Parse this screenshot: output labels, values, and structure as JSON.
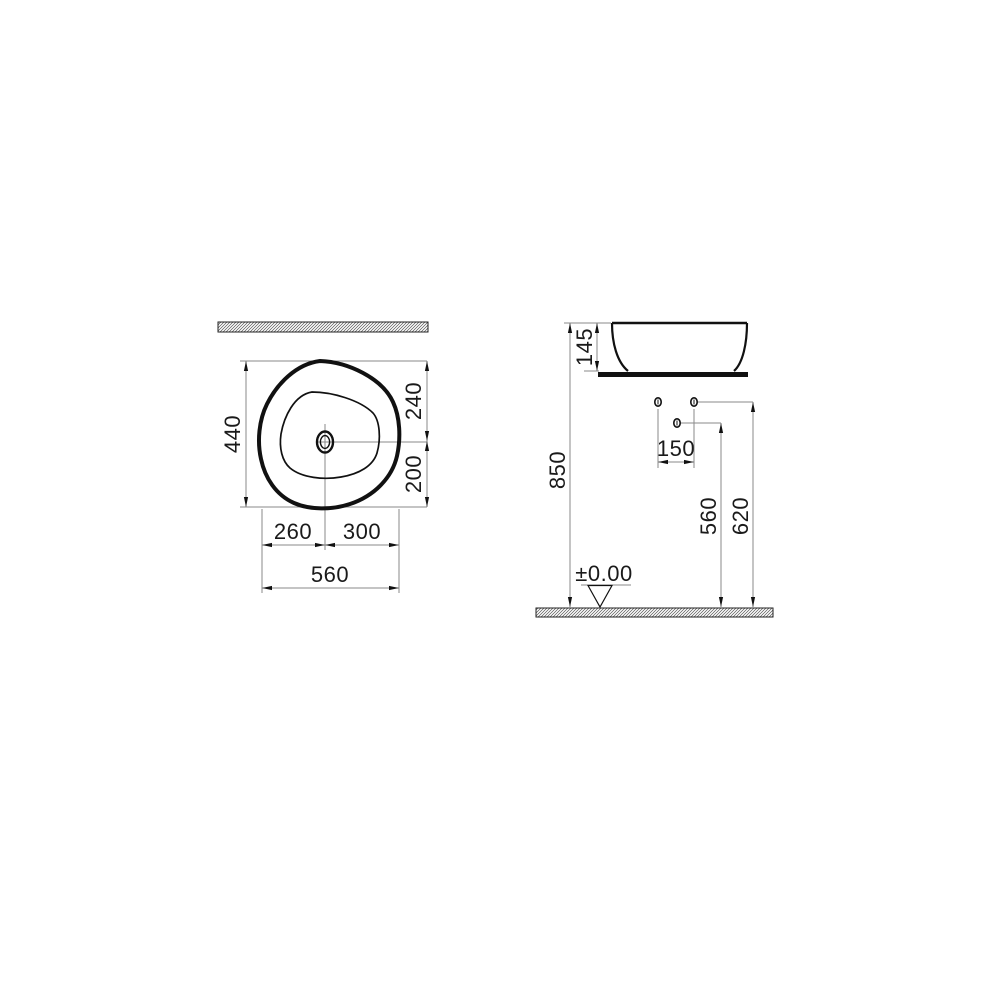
{
  "page": {
    "background": "#ffffff"
  },
  "drawing": {
    "type": "technical-dimension-drawing",
    "subject": "countertop washbasin, plan view and side elevation",
    "views": {
      "plan": {
        "name": "plan-view",
        "dimensions": {
          "overall_depth": "440",
          "edge_to_drain": "240",
          "drain_to_edge": "200",
          "left_of_drain": "260",
          "right_of_drain": "300",
          "overall_width": "560"
        }
      },
      "side": {
        "name": "side-elevation",
        "dimensions": {
          "basin_height": "145",
          "rim_height_from_floor": "850",
          "tap_hole_spacing": "150",
          "mixer_hole_height": "560",
          "supply_hole_height": "620",
          "floor_datum": "±0.00"
        }
      }
    },
    "colors": {
      "object_line": "#111111",
      "dimension_line": "#8a8a8a",
      "text": "#1a1a1a",
      "hatch": "#555555",
      "background": "#ffffff"
    }
  }
}
